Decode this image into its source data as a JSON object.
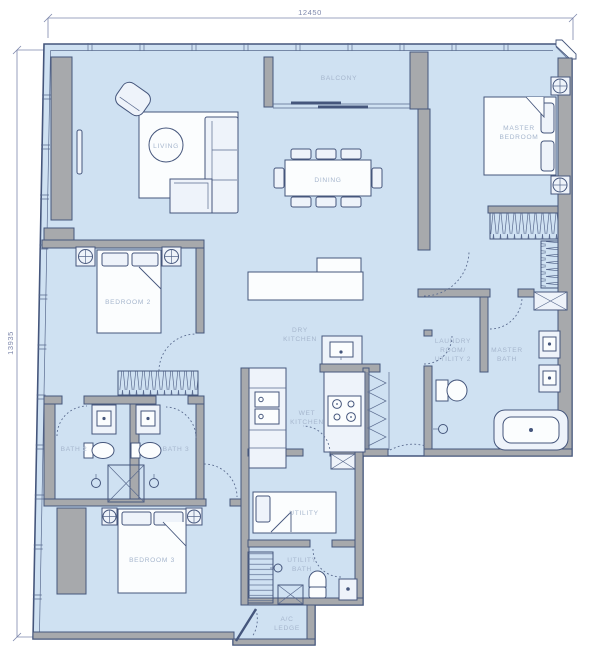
{
  "title": "Apartment floor plan",
  "dimensions": {
    "top": "12450",
    "left": "13935"
  },
  "labels": {
    "balcony": "BALCONY",
    "living": "LIVING",
    "dining": "DINING",
    "master_bedroom": [
      "MASTER",
      "BEDROOM"
    ],
    "bedroom_2": "BEDROOM 2",
    "bedroom_3": "BEDROOM 3",
    "dry_kitchen": [
      "DRY",
      "KITCHEN"
    ],
    "wet_kitchen": [
      "WET",
      "KITCHEN"
    ],
    "laundry": [
      "LAUNDRY",
      "ROOM/",
      "UTILITY 2"
    ],
    "master_bath": [
      "MASTER",
      "BATH"
    ],
    "bath_2": "BATH 2",
    "bath_3": "BATH 3",
    "utility": "UTILITY",
    "utility_bath": [
      "UTILITY",
      "BATH"
    ],
    "ac_ledge": [
      "A/C",
      "LEDGE"
    ]
  },
  "colors": {
    "floor": "#cfe1f2",
    "wall_fill": "#a7a9ac",
    "line": "#45567c",
    "room_label": "#a6b6cd",
    "dimension": "#7e88ac",
    "background": "#ffffff"
  }
}
